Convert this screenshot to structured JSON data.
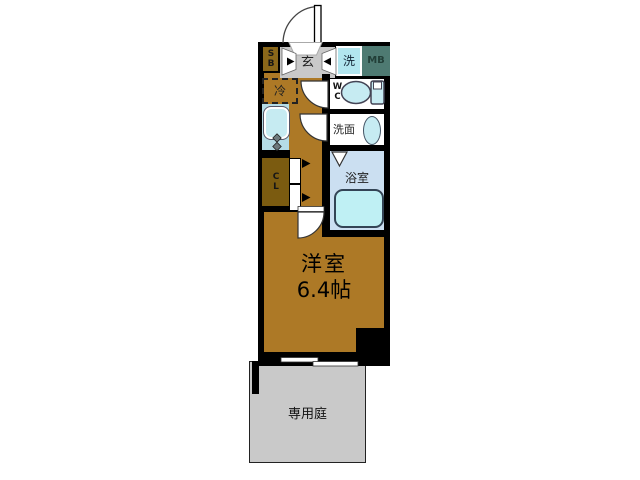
{
  "floor_plan": {
    "rooms": {
      "entrance": {
        "label": "玄"
      },
      "shoe_box": {
        "label": "SB"
      },
      "washer": {
        "label": "洗"
      },
      "meter_box": {
        "label": "MB"
      },
      "refrigerator": {
        "label": "冷"
      },
      "toilet": {
        "label": "WC"
      },
      "washroom": {
        "label": "洗面"
      },
      "bathroom": {
        "label": "浴室"
      },
      "closet": {
        "label": "CL"
      },
      "western_room": {
        "label": "洋室",
        "size": "6.4帖"
      },
      "private_garden": {
        "label": "専用庭"
      }
    },
    "colors": {
      "wall": "#000000",
      "wood_floor": "#ad7926",
      "closet_floor": "#7b5b10",
      "shoe_box": "#8a671a",
      "entrance_floor": "#c9c9c9",
      "washer_panel": "#b2e6ef",
      "meter_box": "#4e7a72",
      "bathroom_floor": "#cbdff1",
      "bathtub": "#bff0f4",
      "fixture": "#c6ebf2",
      "kitchen_counter": "#b5dce6",
      "garden": "#c9c9c9",
      "background": "#ffffff"
    }
  }
}
